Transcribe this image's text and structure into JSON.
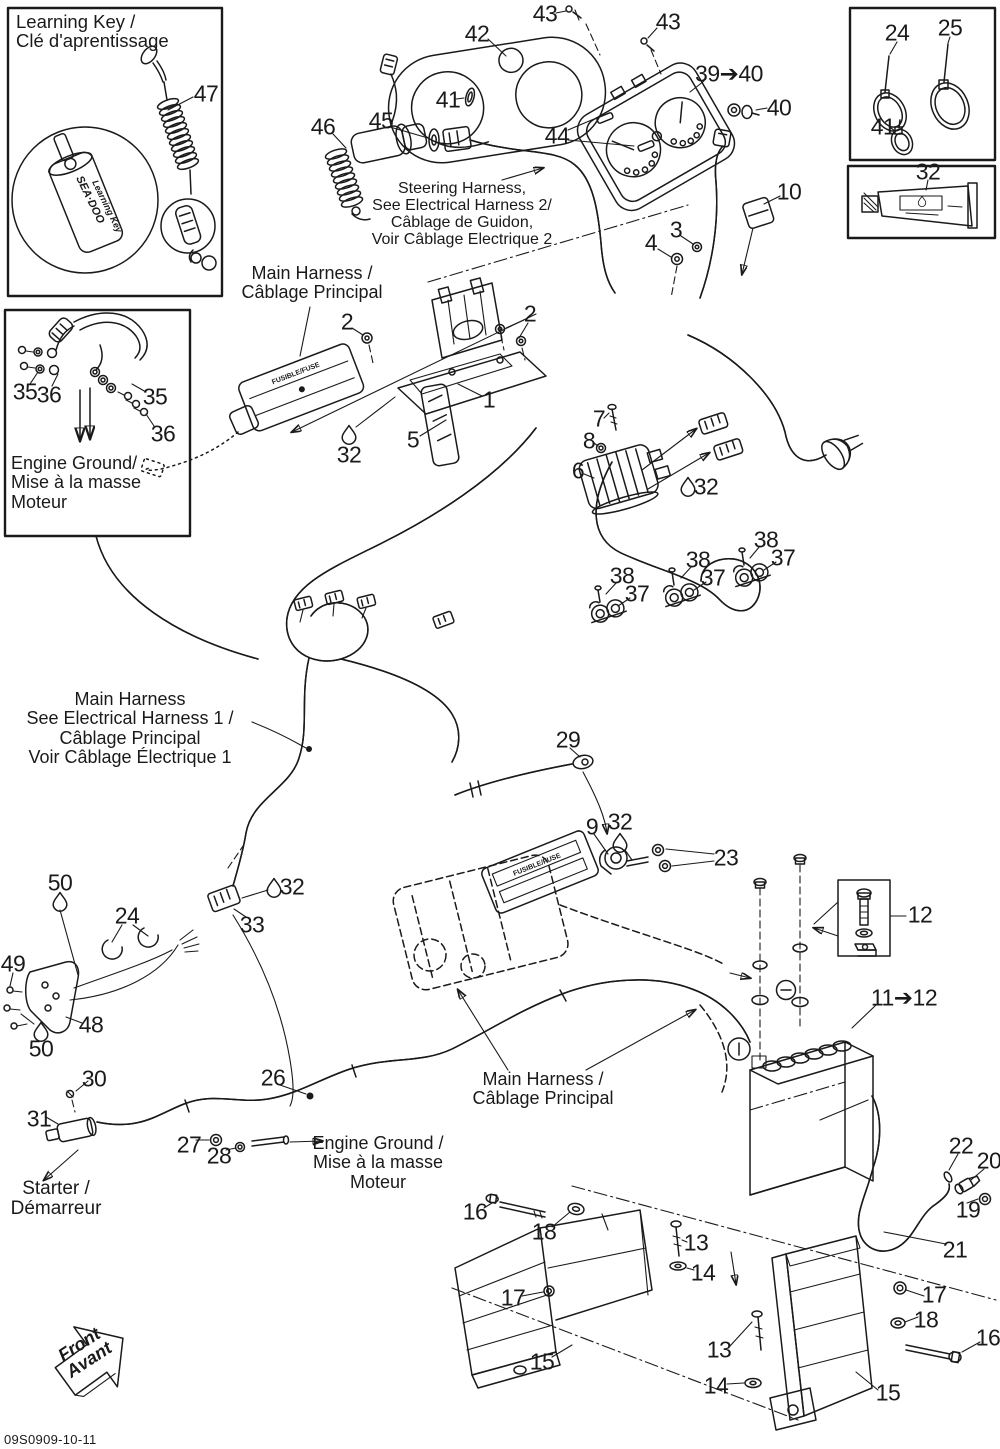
{
  "page": {
    "bg": "#ffffff",
    "ink": "#1a1a1a",
    "doc_code": "09S0909-10-11"
  },
  "insets": {
    "learning_key": {
      "title": [
        "Learning Key /",
        "Clé d'aprentissage"
      ],
      "brand": "SEA·DOO",
      "brand_sub": "Learning Key"
    },
    "engine_ground": {
      "caption": [
        "Engine Ground/",
        "Mise à la masse",
        "Moteur"
      ]
    }
  },
  "annotations": {
    "steering_harness": [
      "Steering Harness,",
      "See Electrical Harness 2/",
      "Câblage de Guidon,",
      "Voir Câblage Electrique 2"
    ],
    "main_harness_top": [
      "Main Harness /",
      "Câblage Principal"
    ],
    "main_harness_left": [
      "Main Harness",
      "See Electrical Harness 1 /",
      "Câblage Principal",
      "Voir Câblage Électrique 1"
    ],
    "main_harness_bottom": [
      "Main Harness /",
      "Câblage Principal"
    ],
    "engine_ground_bottom": [
      "Engine Ground /",
      "Mise à la masse",
      "Moteur"
    ],
    "starter": [
      "Starter /",
      "Démarreur"
    ],
    "front_marker": [
      "Front",
      "Avant"
    ],
    "fuse_label": "FUSIBLE/FUSE"
  },
  "callouts": [
    {
      "id": "47",
      "label": "47",
      "x": 206,
      "y": 94
    },
    {
      "id": "43-left",
      "label": "43",
      "x": 545,
      "y": 14
    },
    {
      "id": "43-right",
      "label": "43",
      "x": 668,
      "y": 22
    },
    {
      "id": "42",
      "label": "42",
      "x": 477,
      "y": 34
    },
    {
      "id": "39-40",
      "label": "39➔40",
      "x": 729,
      "y": 74
    },
    {
      "id": "41-gauge",
      "label": "41",
      "x": 448,
      "y": 100
    },
    {
      "id": "40",
      "label": "40",
      "x": 779,
      "y": 108
    },
    {
      "id": "46",
      "label": "46",
      "x": 323,
      "y": 127
    },
    {
      "id": "45",
      "label": "45",
      "x": 381,
      "y": 121
    },
    {
      "id": "44",
      "label": "44",
      "x": 557,
      "y": 136
    },
    {
      "id": "24-box",
      "label": "24",
      "x": 897,
      "y": 33
    },
    {
      "id": "25-box",
      "label": "25",
      "x": 950,
      "y": 28
    },
    {
      "id": "41-box",
      "label": "41",
      "x": 883,
      "y": 127
    },
    {
      "id": "32-tube",
      "label": "32",
      "x": 928,
      "y": 172
    },
    {
      "id": "10",
      "label": "10",
      "x": 789,
      "y": 192
    },
    {
      "id": "3",
      "label": "3",
      "x": 676,
      "y": 230
    },
    {
      "id": "4",
      "label": "4",
      "x": 651,
      "y": 243
    },
    {
      "id": "2-left",
      "label": "2",
      "x": 347,
      "y": 322
    },
    {
      "id": "2-right",
      "label": "2",
      "x": 530,
      "y": 314
    },
    {
      "id": "1",
      "label": "1",
      "x": 489,
      "y": 400
    },
    {
      "id": "5",
      "label": "5",
      "x": 413,
      "y": 440
    },
    {
      "id": "32-plate",
      "label": "32",
      "x": 349,
      "y": 455
    },
    {
      "id": "35-left",
      "label": "35",
      "x": 25,
      "y": 392
    },
    {
      "id": "36-left",
      "label": "36",
      "x": 49,
      "y": 395
    },
    {
      "id": "35-right",
      "label": "35",
      "x": 155,
      "y": 397
    },
    {
      "id": "36-right",
      "label": "36",
      "x": 163,
      "y": 434
    },
    {
      "id": "7",
      "label": "7",
      "x": 599,
      "y": 419
    },
    {
      "id": "8",
      "label": "8",
      "x": 589,
      "y": 441
    },
    {
      "id": "6",
      "label": "6",
      "x": 578,
      "y": 471
    },
    {
      "id": "32-regulator",
      "label": "32",
      "x": 706,
      "y": 487
    },
    {
      "id": "38-a",
      "label": "38",
      "x": 622,
      "y": 576
    },
    {
      "id": "37-a",
      "label": "37",
      "x": 637,
      "y": 594
    },
    {
      "id": "38-b",
      "label": "38",
      "x": 698,
      "y": 560
    },
    {
      "id": "37-b",
      "label": "37",
      "x": 713,
      "y": 578
    },
    {
      "id": "38-c",
      "label": "38",
      "x": 766,
      "y": 540
    },
    {
      "id": "37-c",
      "label": "37",
      "x": 783,
      "y": 558
    },
    {
      "id": "29",
      "label": "29",
      "x": 568,
      "y": 740
    },
    {
      "id": "9",
      "label": "9",
      "x": 592,
      "y": 827
    },
    {
      "id": "32-solenoid",
      "label": "32",
      "x": 620,
      "y": 822
    },
    {
      "id": "23",
      "label": "23",
      "x": 726,
      "y": 858
    },
    {
      "id": "12",
      "label": "12",
      "x": 920,
      "y": 915
    },
    {
      "id": "50-top",
      "label": "50",
      "x": 60,
      "y": 883
    },
    {
      "id": "24-mid",
      "label": "24",
      "x": 127,
      "y": 916
    },
    {
      "id": "49",
      "label": "49",
      "x": 13,
      "y": 964
    },
    {
      "id": "48",
      "label": "48",
      "x": 91,
      "y": 1025
    },
    {
      "id": "50-bottom",
      "label": "50",
      "x": 41,
      "y": 1049
    },
    {
      "id": "32-conn",
      "label": "32",
      "x": 292,
      "y": 887
    },
    {
      "id": "33",
      "label": "33",
      "x": 252,
      "y": 925
    },
    {
      "id": "11-12",
      "label": "11➔12",
      "x": 904,
      "y": 998
    },
    {
      "id": "30",
      "label": "30",
      "x": 94,
      "y": 1079
    },
    {
      "id": "31",
      "label": "31",
      "x": 39,
      "y": 1119
    },
    {
      "id": "26",
      "label": "26",
      "x": 273,
      "y": 1078
    },
    {
      "id": "27",
      "label": "27",
      "x": 189,
      "y": 1145
    },
    {
      "id": "28",
      "label": "28",
      "x": 219,
      "y": 1156
    },
    {
      "id": "22",
      "label": "22",
      "x": 961,
      "y": 1146
    },
    {
      "id": "20",
      "label": "20",
      "x": 989,
      "y": 1161
    },
    {
      "id": "19",
      "label": "19",
      "x": 968,
      "y": 1210
    },
    {
      "id": "21",
      "label": "21",
      "x": 955,
      "y": 1250
    },
    {
      "id": "16-left",
      "label": "16",
      "x": 475,
      "y": 1212
    },
    {
      "id": "18-left",
      "label": "18",
      "x": 544,
      "y": 1232
    },
    {
      "id": "13-left",
      "label": "13",
      "x": 696,
      "y": 1243
    },
    {
      "id": "14-left",
      "label": "14",
      "x": 703,
      "y": 1273
    },
    {
      "id": "17-left",
      "label": "17",
      "x": 513,
      "y": 1298
    },
    {
      "id": "15-left",
      "label": "15",
      "x": 542,
      "y": 1362
    },
    {
      "id": "13-right",
      "label": "13",
      "x": 719,
      "y": 1350
    },
    {
      "id": "14-right",
      "label": "14",
      "x": 716,
      "y": 1386
    },
    {
      "id": "17-right",
      "label": "17",
      "x": 934,
      "y": 1295
    },
    {
      "id": "18-right",
      "label": "18",
      "x": 926,
      "y": 1320
    },
    {
      "id": "16-right",
      "label": "16",
      "x": 988,
      "y": 1338
    },
    {
      "id": "15-right",
      "label": "15",
      "x": 888,
      "y": 1393
    }
  ]
}
